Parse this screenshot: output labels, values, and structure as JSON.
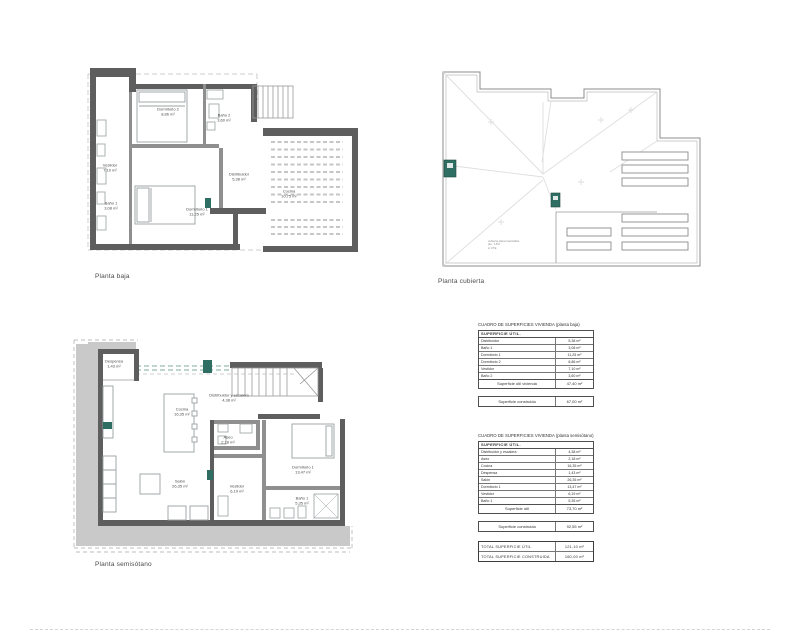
{
  "plans": {
    "baja": {
      "label": "Planta baja",
      "rooms": [
        {
          "name": "Dormitorio 2",
          "area": "8,86 m²"
        },
        {
          "name": "Baño 2",
          "area": "3,60 m²"
        },
        {
          "name": "Vestidor",
          "area": "7,10 m²"
        },
        {
          "name": "Baño 1",
          "area": "3,08 m²"
        },
        {
          "name": "Distribuidor",
          "area": "5,38 m²"
        },
        {
          "name": "Dormitorio 1",
          "area": "11,25 m²"
        },
        {
          "name": "Cocina",
          "area": "10,75 m²"
        }
      ]
    },
    "cubierta": {
      "label": "Planta cubierta",
      "note_lines": [
        "cubierta plana transitable",
        "pte. 1,5%",
        "s/ CTE"
      ]
    },
    "semisotano": {
      "label": "Planta semisótano",
      "rooms": [
        {
          "name": "Despensa",
          "area": "1,43 m²"
        },
        {
          "name": "Cocina",
          "area": "16,35 m²"
        },
        {
          "name": "Distribuidor y escalera",
          "area": "4,38 m²"
        },
        {
          "name": "Aseo",
          "area": "2,18 m²"
        },
        {
          "name": "Salón",
          "area": "26,35 m²"
        },
        {
          "name": "Vestidor",
          "area": "6,19 m²"
        },
        {
          "name": "Dormitorio 1",
          "area": "13,47 m²"
        },
        {
          "name": "Baño 1",
          "area": "5,35 m²"
        }
      ]
    }
  },
  "tables": [
    {
      "title": "CUADRO DE SUPERFICIES VIVIENDA (planta baja)",
      "header": "SUPERFICIE  ÚTIL.",
      "rows": [
        {
          "label": "Distribuidor",
          "value": "5,38 m²"
        },
        {
          "label": "Baño 1",
          "value": "3,08 m²"
        },
        {
          "label": "Dormitorio 1",
          "value": "11,25 m²"
        },
        {
          "label": "Dormitorio 2",
          "value": "8,86 m²"
        },
        {
          "label": "Vestidor",
          "value": "7,10 m²"
        },
        {
          "label": "Baño 2",
          "value": "3,60 m²"
        }
      ],
      "total_label": "Superficie útil vivienda",
      "total_value": "47,40 m²",
      "built_label": "Superficie construida",
      "built_value": "67,00 m²"
    },
    {
      "title": "CUADRO DE SUPERFICIES VIVIENDA (planta semisótano)",
      "header": "SUPERFICIE  ÚTIL.",
      "rows": [
        {
          "label": "Distribuidor y escalera",
          "value": "4,38 m²"
        },
        {
          "label": "Aseo",
          "value": "2,18 m²"
        },
        {
          "label": "Cocina",
          "value": "16,35 m²"
        },
        {
          "label": "Despensa",
          "value": "1,43 m²"
        },
        {
          "label": "Salón",
          "value": "26,35 m²"
        },
        {
          "label": "Dormitorio 1",
          "value": "13,47 m²"
        },
        {
          "label": "Vestidor",
          "value": "6,19 m²"
        },
        {
          "label": "Baño 1",
          "value": "5,35 m²"
        }
      ],
      "total_label": "Superficie útil",
      "total_value": "73,70 m²",
      "built_label": "Superficie construida",
      "built_value": "92,55 m²"
    }
  ],
  "totals": {
    "rows": [
      {
        "label": "TOTAL SUPERFICIE  ÚTIL",
        "value": "121,10 m²"
      },
      {
        "label": "TOTAL SUPERFICIE  CONSTRUIDA",
        "value": "160,00 m²"
      }
    ]
  },
  "colors": {
    "wall": "#5e5e5e",
    "wall_light": "#8f8f8f",
    "earth": "#c9c9c9",
    "teal": "#2f6e63",
    "furniture_line": "#9aa0a0",
    "faint_line": "#dedede"
  }
}
